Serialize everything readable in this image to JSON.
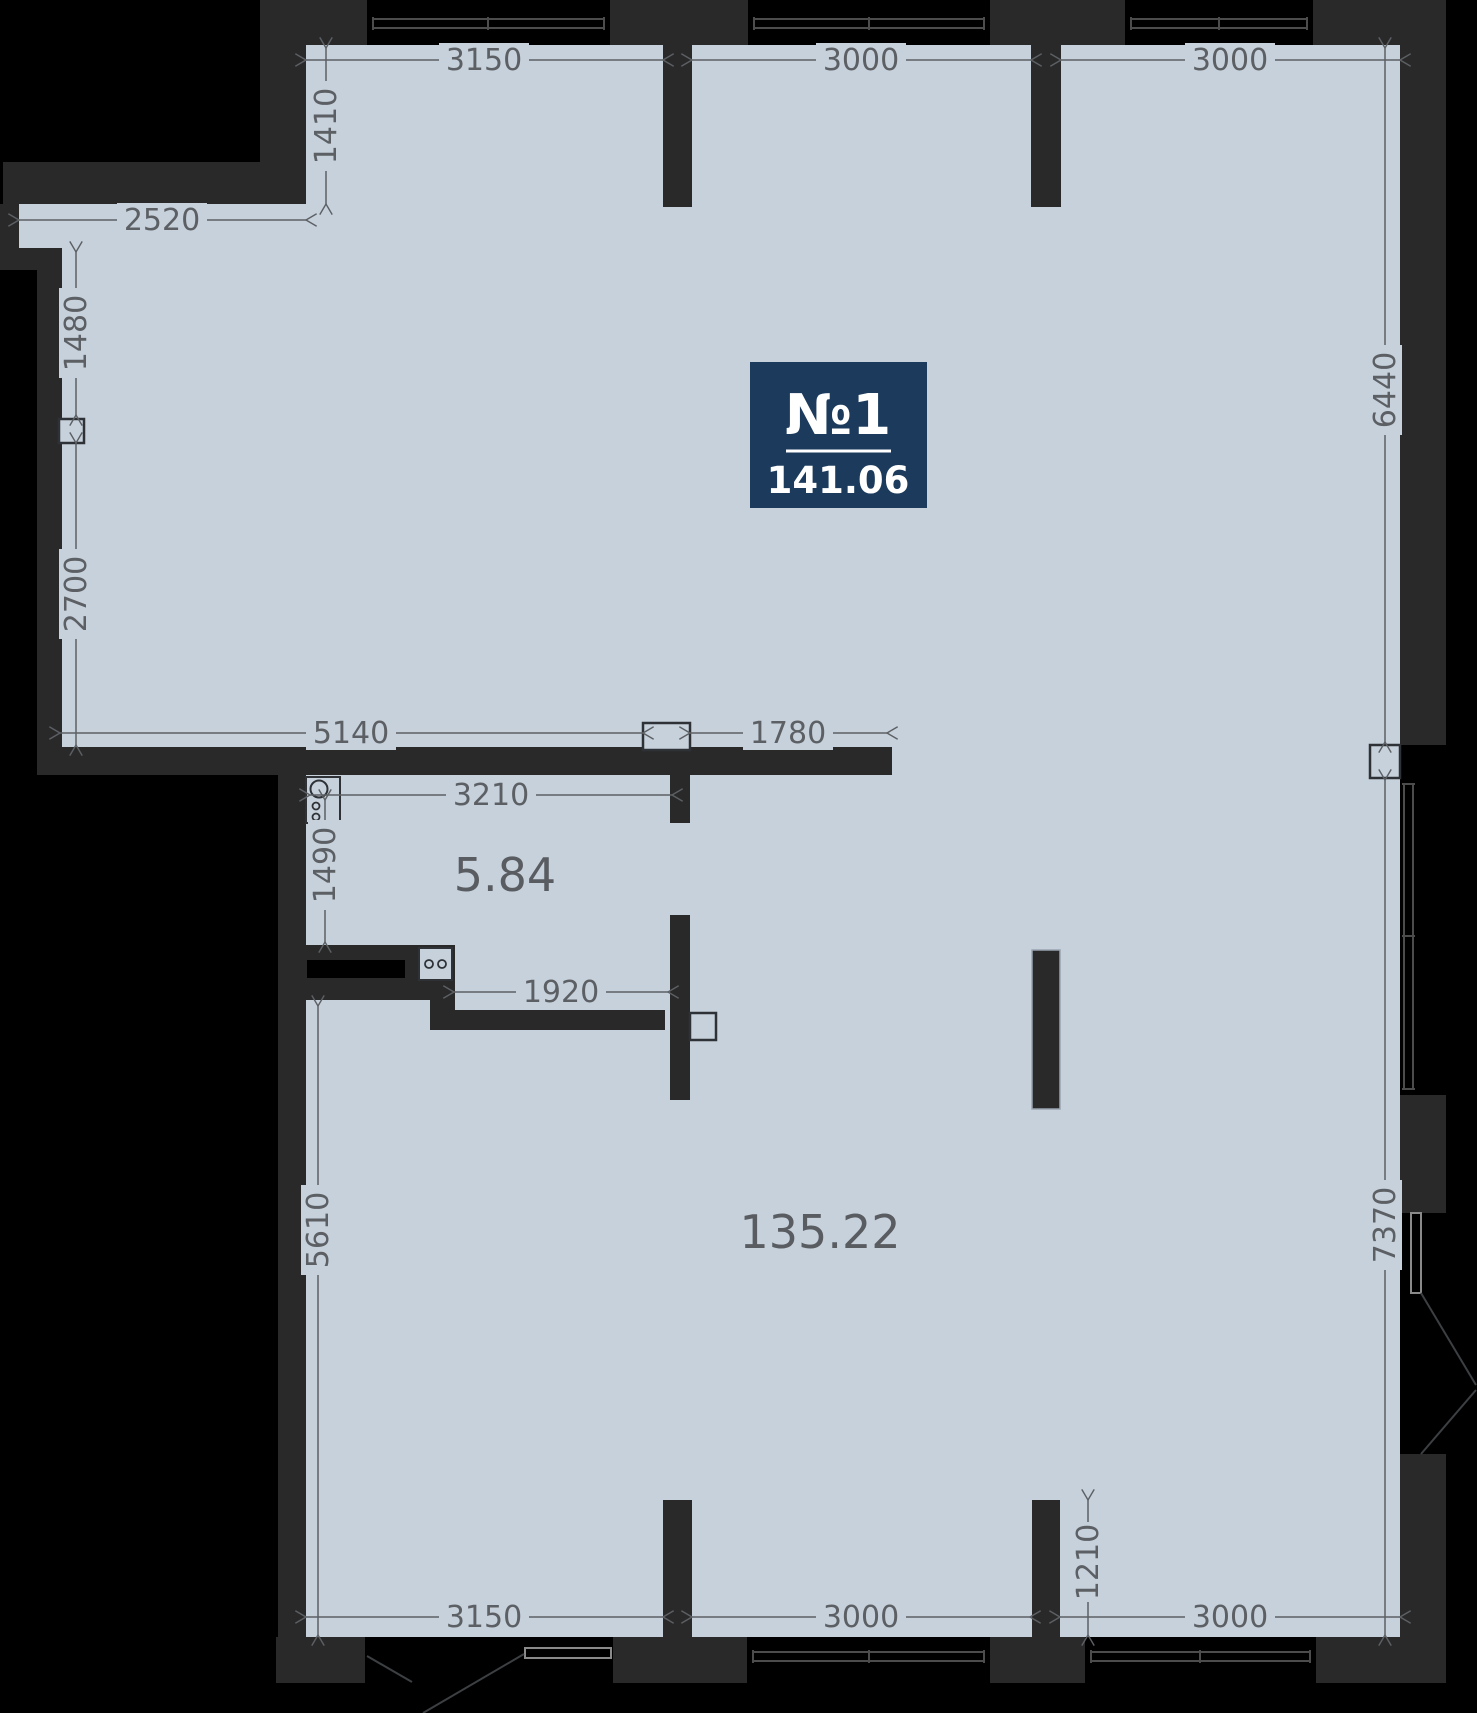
{
  "badge": {
    "unit_number": "№1",
    "area": "141.06"
  },
  "areas": {
    "niche": "5.84",
    "main": "135.22"
  },
  "dims": {
    "top_bay_1": "3150",
    "top_bay_2": "3000",
    "top_bay_3": "3000",
    "left_recess": "1410",
    "left_strip": "2520",
    "left_upper": "1480",
    "left_lower": "2700",
    "right_upper": "6440",
    "right_lower": "7370",
    "mid_left": "5140",
    "mid_right": "1780",
    "niche_width": "3210",
    "niche_height": "1490",
    "niche_opening": "1920",
    "lower_left_height": "5610",
    "pier_offset": "1210",
    "bottom_bay_1": "3150",
    "bottom_bay_2": "3000",
    "bottom_bay_3": "3000"
  },
  "colors": {
    "background": "#000000",
    "wall": "#292929",
    "floor": "#c7d1dc",
    "dimension": "#5c6064",
    "badge_background": "#1b3a5c",
    "badge_text": "#ffffff"
  }
}
